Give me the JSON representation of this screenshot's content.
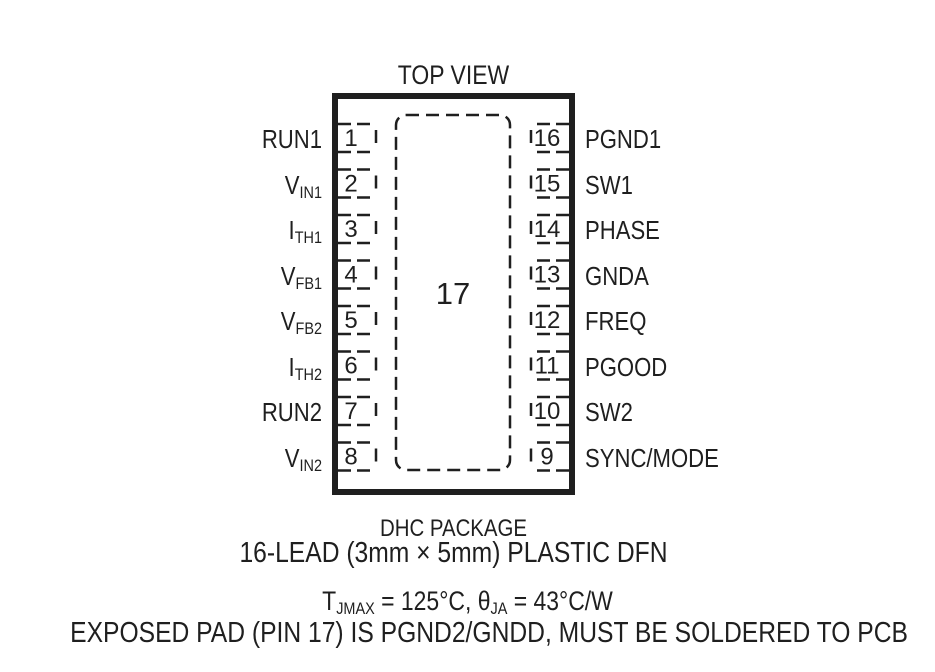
{
  "title": "TOP VIEW",
  "colors": {
    "ink": "#1f1f1f",
    "background": "#ffffff"
  },
  "chip": {
    "pad_number": "17",
    "left_pins": [
      {
        "num": "1",
        "name": "RUN1",
        "sub": ""
      },
      {
        "num": "2",
        "name": "V",
        "sub": "IN1"
      },
      {
        "num": "3",
        "name": "I",
        "sub": "TH1"
      },
      {
        "num": "4",
        "name": "V",
        "sub": "FB1"
      },
      {
        "num": "5",
        "name": "V",
        "sub": "FB2"
      },
      {
        "num": "6",
        "name": "I",
        "sub": "TH2"
      },
      {
        "num": "7",
        "name": "RUN2",
        "sub": ""
      },
      {
        "num": "8",
        "name": "V",
        "sub": "IN2"
      }
    ],
    "right_pins": [
      {
        "num": "16",
        "name": "PGND1"
      },
      {
        "num": "15",
        "name": "SW1"
      },
      {
        "num": "14",
        "name": "PHASE"
      },
      {
        "num": "13",
        "name": "GNDA"
      },
      {
        "num": "12",
        "name": "FREQ"
      },
      {
        "num": "11",
        "name": "PGOOD"
      },
      {
        "num": "10",
        "name": "SW2"
      },
      {
        "num": "9",
        "name": "SYNC/MODE"
      }
    ]
  },
  "captions": {
    "package_name": "DHC PACKAGE",
    "package_desc": "16-LEAD (3mm × 5mm) PLASTIC DFN"
  },
  "notes": {
    "thermal": {
      "p1": "T",
      "p1sub": "JMAX",
      "p2": " = 125°C, ",
      "p3": "θ",
      "p3sub": "JA",
      "p4": " = 43°C/W"
    },
    "exposed_pad": "EXPOSED PAD (PIN 17) IS PGND2/GNDD, MUST BE SOLDERED TO PCB"
  }
}
